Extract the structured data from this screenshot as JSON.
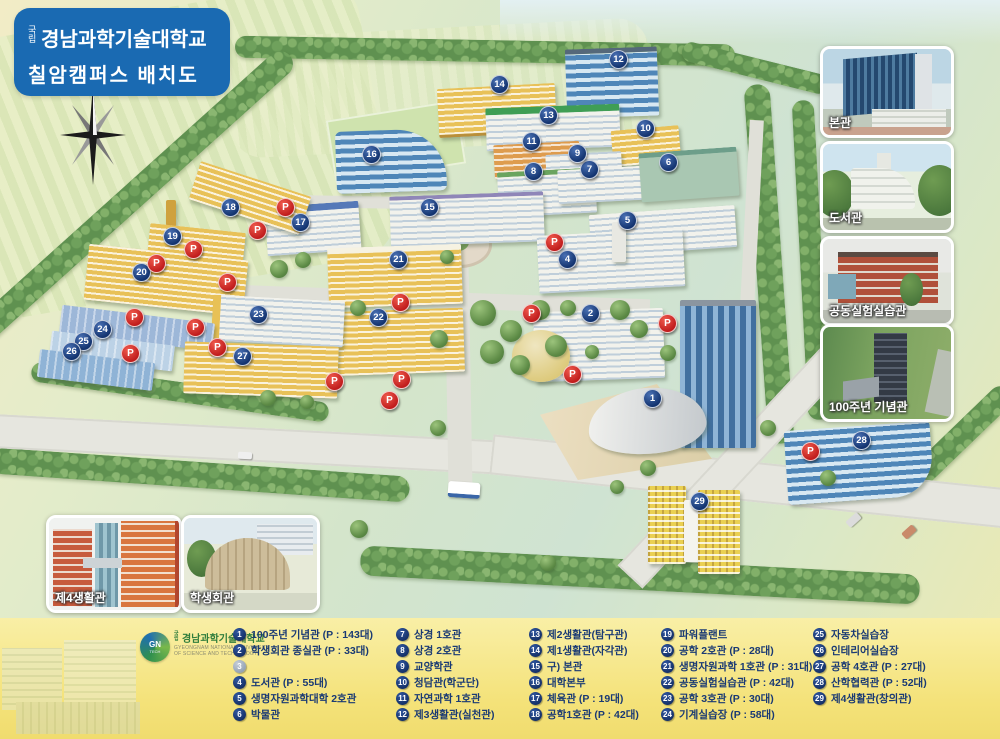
{
  "title": {
    "affix": "국립",
    "name": "경남과학기술대학교",
    "subtitle": "칠암캠퍼스 배치도"
  },
  "compass": {
    "north": "N"
  },
  "photos_right": [
    {
      "label": "본관"
    },
    {
      "label": "도서관"
    },
    {
      "label": "공동실험실습관"
    },
    {
      "label": "100주년 기념관"
    }
  ],
  "photos_bottom": [
    {
      "label": "제4생활관"
    },
    {
      "label": "학생회관"
    }
  ],
  "legend": {
    "logo": {
      "badge_top": "GN",
      "badge_bottom": "TECH",
      "affix": "국립",
      "name": "경남과학기술대학교",
      "en_line1": "GYEONGNAM NATIONAL UNIVERSITY",
      "en_line2": "OF SCIENCE AND TECHNOLOGY"
    },
    "columns": [
      [
        {
          "num": "1",
          "label": "100주년 기념관 (P : 143대)"
        },
        {
          "num": "2",
          "label": "학생회관 종실관 (P : 33대)"
        },
        {
          "num": "3",
          "label": "",
          "empty": true
        },
        {
          "num": "4",
          "label": "도서관 (P : 55대)"
        },
        {
          "num": "5",
          "label": "생명자원과학대학 2호관"
        },
        {
          "num": "6",
          "label": "박물관"
        }
      ],
      [
        {
          "num": "7",
          "label": "상경 1호관"
        },
        {
          "num": "8",
          "label": "상경 2호관"
        },
        {
          "num": "9",
          "label": "교양학관"
        },
        {
          "num": "10",
          "label": "청담관(학군단)"
        },
        {
          "num": "11",
          "label": "자연과학 1호관"
        },
        {
          "num": "12",
          "label": "제3생활관(실천관)"
        }
      ],
      [
        {
          "num": "13",
          "label": "제2생활관(탐구관)"
        },
        {
          "num": "14",
          "label": "제1생활관(자각관)"
        },
        {
          "num": "15",
          "label": "구) 본관"
        },
        {
          "num": "16",
          "label": "대학본부"
        },
        {
          "num": "17",
          "label": "체육관 (P : 19대)"
        },
        {
          "num": "18",
          "label": "공학1호관 (P : 42대)"
        }
      ],
      [
        {
          "num": "19",
          "label": "파워플랜트"
        },
        {
          "num": "20",
          "label": "공학 2호관 (P : 28대)"
        },
        {
          "num": "21",
          "label": "생명자원과학 1호관 (P : 31대)"
        },
        {
          "num": "22",
          "label": "공동실험실습관 (P : 42대)"
        },
        {
          "num": "23",
          "label": "공학 3호관 (P : 30대)"
        },
        {
          "num": "24",
          "label": "기계실습장 (P : 58대)"
        }
      ],
      [
        {
          "num": "25",
          "label": "자동차실습장"
        },
        {
          "num": "26",
          "label": "인테리어실습장"
        },
        {
          "num": "27",
          "label": "공학 4호관 (P : 27대)"
        },
        {
          "num": "28",
          "label": "산학협력관 (P : 52대)"
        },
        {
          "num": "29",
          "label": "제4생활관(창의관)"
        }
      ]
    ]
  },
  "map": {
    "parking_symbol": "P",
    "colors": {
      "marker_blue": "#14336f",
      "parking_red": "#c01c1c",
      "title_blue": "#1a6ab2",
      "legend_yellow": "#f4e279",
      "legend_text": "#1a3a74"
    },
    "markers": [
      {
        "n": "1",
        "x": 652,
        "y": 398
      },
      {
        "n": "2",
        "x": 590,
        "y": 313
      },
      {
        "n": "4",
        "x": 567,
        "y": 259
      },
      {
        "n": "5",
        "x": 627,
        "y": 220
      },
      {
        "n": "6",
        "x": 668,
        "y": 162
      },
      {
        "n": "7",
        "x": 589,
        "y": 169
      },
      {
        "n": "8",
        "x": 533,
        "y": 171
      },
      {
        "n": "9",
        "x": 577,
        "y": 153
      },
      {
        "n": "10",
        "x": 645,
        "y": 128
      },
      {
        "n": "11",
        "x": 531,
        "y": 141
      },
      {
        "n": "12",
        "x": 618,
        "y": 59
      },
      {
        "n": "13",
        "x": 548,
        "y": 115
      },
      {
        "n": "14",
        "x": 499,
        "y": 84
      },
      {
        "n": "15",
        "x": 429,
        "y": 207
      },
      {
        "n": "16",
        "x": 371,
        "y": 154
      },
      {
        "n": "17",
        "x": 300,
        "y": 222
      },
      {
        "n": "18",
        "x": 230,
        "y": 207
      },
      {
        "n": "19",
        "x": 172,
        "y": 236
      },
      {
        "n": "20",
        "x": 141,
        "y": 272
      },
      {
        "n": "21",
        "x": 398,
        "y": 259
      },
      {
        "n": "22",
        "x": 378,
        "y": 317
      },
      {
        "n": "23",
        "x": 258,
        "y": 314
      },
      {
        "n": "24",
        "x": 102,
        "y": 329
      },
      {
        "n": "25",
        "x": 83,
        "y": 341
      },
      {
        "n": "26",
        "x": 71,
        "y": 351
      },
      {
        "n": "27",
        "x": 242,
        "y": 356
      },
      {
        "n": "28",
        "x": 861,
        "y": 440
      },
      {
        "n": "29",
        "x": 699,
        "y": 501
      }
    ],
    "parking": [
      {
        "x": 285,
        "y": 207
      },
      {
        "x": 257,
        "y": 230
      },
      {
        "x": 193,
        "y": 249
      },
      {
        "x": 156,
        "y": 263
      },
      {
        "x": 227,
        "y": 282
      },
      {
        "x": 134,
        "y": 317
      },
      {
        "x": 195,
        "y": 327
      },
      {
        "x": 130,
        "y": 353
      },
      {
        "x": 217,
        "y": 347
      },
      {
        "x": 554,
        "y": 242
      },
      {
        "x": 400,
        "y": 302
      },
      {
        "x": 531,
        "y": 313
      },
      {
        "x": 334,
        "y": 381
      },
      {
        "x": 401,
        "y": 379
      },
      {
        "x": 389,
        "y": 400
      },
      {
        "x": 572,
        "y": 374
      },
      {
        "x": 667,
        "y": 323
      },
      {
        "x": 810,
        "y": 451
      }
    ]
  }
}
